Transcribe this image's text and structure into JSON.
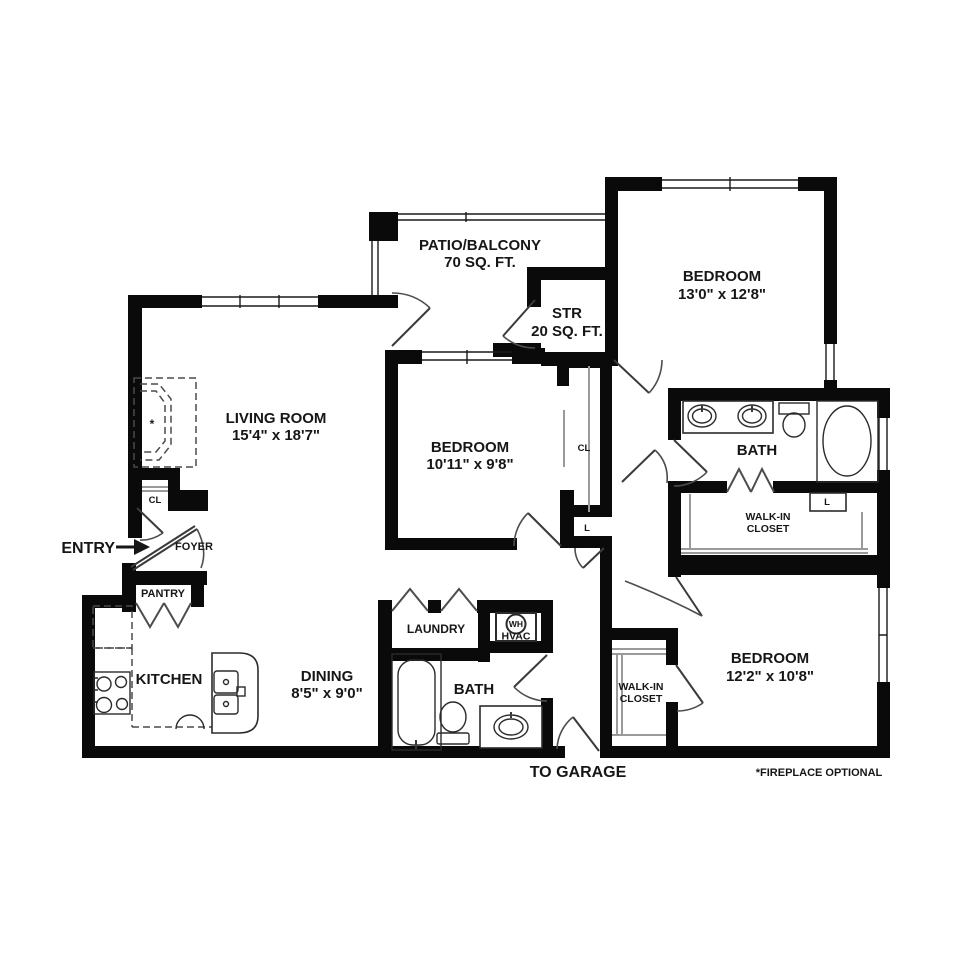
{
  "rooms": {
    "patio": {
      "name": "PATIO/BALCONY",
      "area": "70 SQ. FT."
    },
    "bedroom_top": {
      "name": "BEDROOM",
      "dims": "13'0\" x 12'8\""
    },
    "storage": {
      "name": "STR",
      "area": "20 SQ. FT."
    },
    "living_room": {
      "name": "LIVING ROOM",
      "dims": "15'4\" x 18'7\""
    },
    "bedroom_mid": {
      "name": "BEDROOM",
      "dims": "10'11\" x 9'8\""
    },
    "bath_top": {
      "name": "BATH"
    },
    "walkin_top": {
      "line1": "WALK-IN",
      "line2": "CLOSET"
    },
    "bedroom_bottom": {
      "name": "BEDROOM",
      "dims": "12'2\" x 10'8\""
    },
    "walkin_bottom": {
      "line1": "WALK-IN",
      "line2": "CLOSET"
    },
    "bath_bottom": {
      "name": "BATH"
    },
    "laundry": {
      "name": "LAUNDRY"
    },
    "kitchen": {
      "name": "KITCHEN"
    },
    "dining": {
      "name": "DINING",
      "dims": "8'5\" x 9'0\""
    },
    "pantry": {
      "name": "PANTRY"
    },
    "foyer": {
      "name": "FOYER"
    }
  },
  "closets": {
    "foyer_closet": "CL",
    "bedroom_closet": "CL",
    "linen_hall": "L",
    "linen_bath": "L"
  },
  "utility": {
    "water_heater": "WH",
    "hvac": "HVAC"
  },
  "annotations": {
    "entry": "ENTRY",
    "to_garage": "TO GARAGE",
    "fireplace_note": "*FIREPLACE OPTIONAL",
    "fireplace_star": "*"
  },
  "colors": {
    "wall": "#0a0a0a",
    "background": "#ffffff",
    "fixture_line": "#2b2b2b",
    "light_line": "#9a9a9a"
  }
}
